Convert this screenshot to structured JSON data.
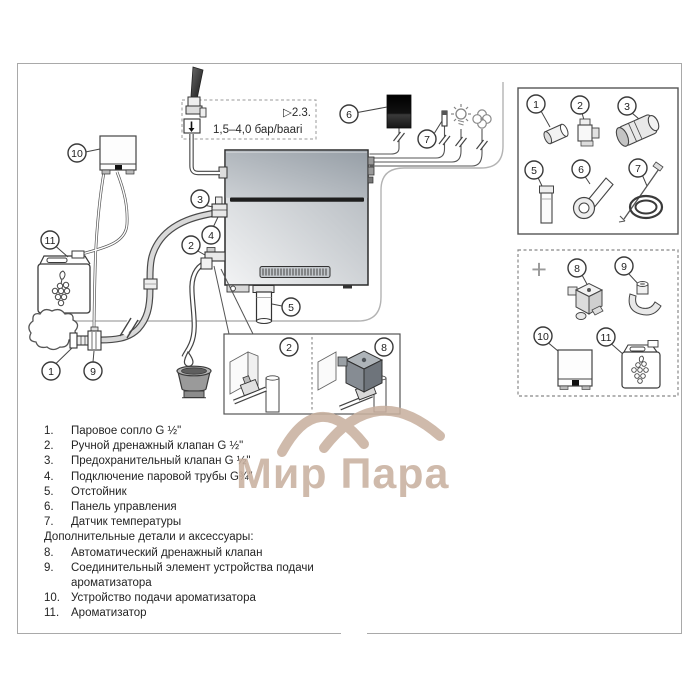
{
  "inlet": {
    "ref": "▷2.3.",
    "pressure": "1,5–4,0 бар/baari"
  },
  "plus_sign": "+",
  "callouts": {
    "n1": "1",
    "n2": "2",
    "n3": "3",
    "n4": "4",
    "n5": "5",
    "n6": "6",
    "n7": "7",
    "n8": "8",
    "n9": "9",
    "n10": "10",
    "n11": "11"
  },
  "legend": {
    "items": [
      {
        "num": "1.",
        "text": "Паровое сопло G ½\""
      },
      {
        "num": "2.",
        "text": "Ручной дренажный клапан G ½\""
      },
      {
        "num": "3.",
        "text": "Предохранительный клапан G ½\""
      },
      {
        "num": "4.",
        "text": "Подключение паровой трубы G¾\""
      },
      {
        "num": "5.",
        "text": "Отстойник"
      },
      {
        "num": "6.",
        "text": "Панель управления"
      },
      {
        "num": "7.",
        "text": "Датчик температуры"
      }
    ],
    "section_header": "Дополнительные детали и аксессуары:",
    "extra_items": [
      {
        "num": "8.",
        "text": "Автоматический дренажный клапан"
      },
      {
        "num": "9.",
        "text": "Соединительный элемент устройства подачи ароматизатора"
      },
      {
        "num": "10.",
        "text": "Устройство подачи ароматизатора"
      },
      {
        "num": "11.",
        "text": "Ароматизатор"
      }
    ]
  },
  "watermark": {
    "text": "Мир Пара",
    "color": "#c9b1a0"
  }
}
